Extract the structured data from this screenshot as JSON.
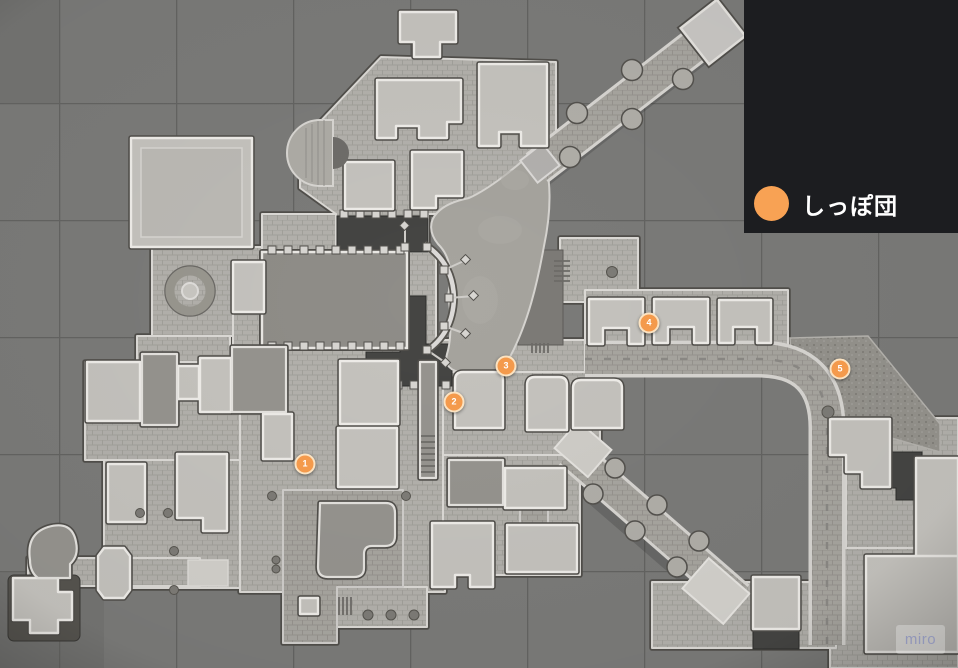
{
  "legend": {
    "background": "#1c1d20",
    "items": [
      {
        "label": "しっぽ団",
        "color": "#f8a254"
      }
    ]
  },
  "markers": {
    "style": {
      "fill": "#f49a4c",
      "ring": "#fbe3c2"
    },
    "items": [
      {
        "label": "1",
        "x": 305,
        "y": 464
      },
      {
        "label": "2",
        "x": 454,
        "y": 402
      },
      {
        "label": "3",
        "x": 506,
        "y": 366
      },
      {
        "label": "4",
        "x": 649,
        "y": 323
      },
      {
        "label": "5",
        "x": 840,
        "y": 369
      }
    ]
  },
  "watermark": {
    "label": "miro"
  }
}
